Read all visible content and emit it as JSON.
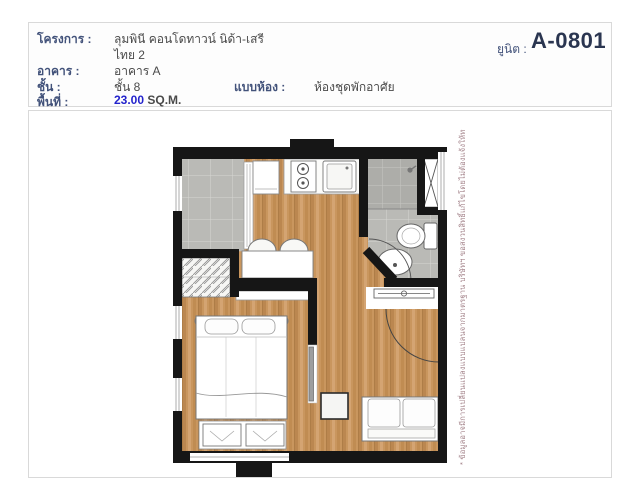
{
  "header": {
    "project_label": "โครงการ :",
    "project_value_line1": "ลุมพินี คอนโดทาวน์ นิด้า-เสรี",
    "project_value_line2": "ไทย 2",
    "building_label": "อาคาร :",
    "building_value": "อาคาร A",
    "floor_label": "ชั้น :",
    "floor_value": "ชั้น 8",
    "room_type_label": "แบบห้อง :",
    "room_type_value": "ห้องชุดพักอาศัย",
    "area_label": "พื้นที่ :",
    "area_value": "23.00",
    "area_unit": "SQ.M.",
    "unit_label": "ยูนิต :",
    "unit_value": "A-0801"
  },
  "floorplan": {
    "disclaimer": "* ข้อมูลอาจมีการเปลี่ยนแปลงแบบแปลนจากมาตรฐาน บริษัทฯ ขอสงวนสิทธิ์แก้ไขโดยไม่ต้องแจ้งให้ทราบล่วงหน้า",
    "rooms": [
      "balcony",
      "kitchen",
      "bathroom",
      "bedroom",
      "living-area",
      "wardrobe",
      "shaft"
    ]
  },
  "colors": {
    "label_navy": "#42527a",
    "unit_navy": "#2a3550",
    "area_blue": "#2323cc",
    "wall_black": "#161616",
    "wood_floor": "#c9965e",
    "tile_gray": "#babab6",
    "shower_tile": "#adada9",
    "disclaimer_text": "#a5858c",
    "panel_border": "#d9d9d9"
  }
}
